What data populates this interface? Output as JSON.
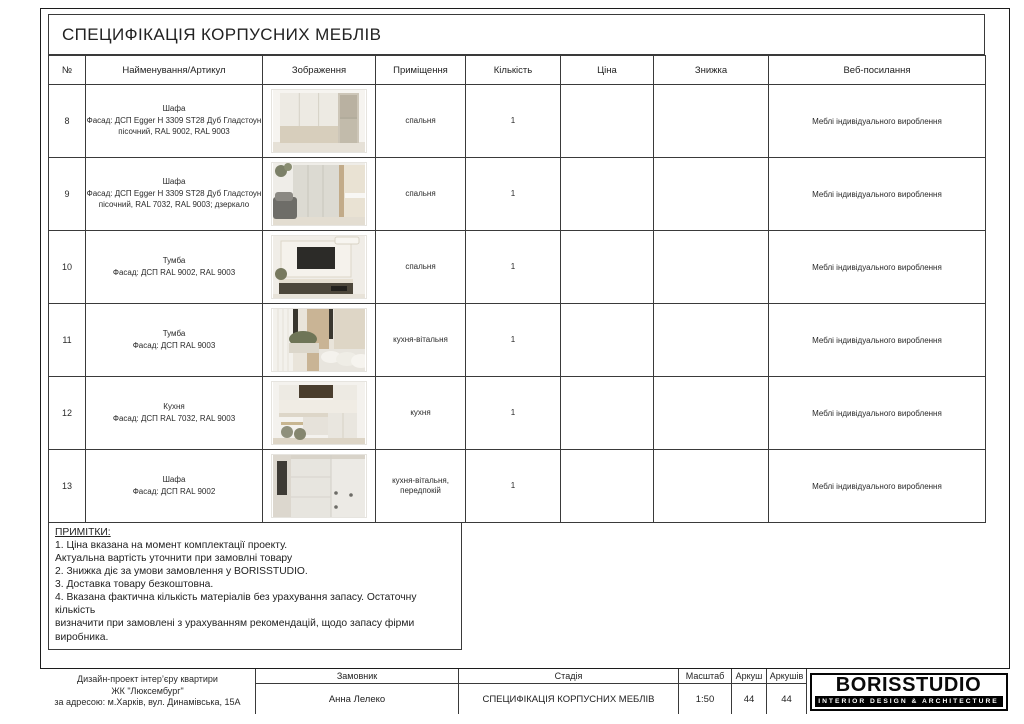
{
  "title": "СПЕЦИФІКАЦІЯ КОРПУСНИХ МЕБЛІВ",
  "colors": {
    "border": "#3a3a3a",
    "outer_border": "#1c1c1c",
    "text": "#222222",
    "logo_bg": "#000000",
    "logo_text": "#ffffff",
    "photo_beige": "#d7cebc",
    "photo_cream": "#edeae3"
  },
  "table": {
    "headers": [
      "№",
      "Найменування/Артикул",
      "Зображення",
      "Приміщення",
      "Кількість",
      "Ціна",
      "Знижка",
      "Веб-посилання"
    ],
    "rows": [
      {
        "num": "8",
        "name": "Шафа",
        "desc": "Фасад: ДСП Egger H 3309 ST28 Дуб Гладстоун пісочний, RAL 9002, RAL 9003",
        "image": "wardrobe-bedroom-photo",
        "room": "спальня",
        "qty": "1",
        "price": "",
        "discount": "",
        "link": "Меблі індивідуального вироблення"
      },
      {
        "num": "9",
        "name": "Шафа",
        "desc": "Фасад: ДСП Egger H 3309 ST28 Дуб Гладстоун пісочний, RAL 7032, RAL 9003; дзеркало",
        "image": "wardrobe-mirror-photo",
        "room": "спальня",
        "qty": "1",
        "price": "",
        "discount": "",
        "link": "Меблі індивідуального вироблення"
      },
      {
        "num": "10",
        "name": "Тумба",
        "desc": "Фасад: ДСП RAL 9002, RAL 9003",
        "image": "tv-stand-photo",
        "room": "спальня",
        "qty": "1",
        "price": "",
        "discount": "",
        "link": "Меблі індивідуального вироблення"
      },
      {
        "num": "11",
        "name": "Тумба",
        "desc": "Фасад: ДСП RAL 9003",
        "image": "cabinet-living-photo",
        "room": "кухня-вітальня",
        "qty": "1",
        "price": "",
        "discount": "",
        "link": "Меблі індивідуального вироблення"
      },
      {
        "num": "12",
        "name": "Кухня",
        "desc": "Фасад: ДСП RAL 7032, RAL 9003",
        "image": "kitchen-photo",
        "room": "кухня",
        "qty": "1",
        "price": "",
        "discount": "",
        "link": "Меблі індивідуального вироблення"
      },
      {
        "num": "13",
        "name": "Шафа",
        "desc": "Фасад: ДСП RAL 9002",
        "image": "hallway-wardrobe-photo",
        "room": "кухня-вітальня, передпокій",
        "qty": "1",
        "price": "",
        "discount": "",
        "link": "Меблі індивідуального вироблення"
      }
    ]
  },
  "notes": {
    "heading": "ПРИМІТКИ:",
    "lines": [
      "1. Ціна вказана на момент комплектації проекту.",
      "Актуальна вартість уточнити при замовлні товару",
      "2. Знижка діє за умови замовлення у BORISSTUDIO.",
      "3. Доставка товару безкоштовна.",
      "4. Вказана фактична кількість матеріалів без урахування запасу. Остаточну кількість",
      "визначити при замовлені з урахуванням рекомендацій, щодо запасу фірми виробника."
    ]
  },
  "footer": {
    "project": [
      "Дизайн-проект інтер’єру квартири",
      "ЖК \"Люксембург\"",
      "за адресою: м.Харків, вул. Динамівська, 15А"
    ],
    "customer_label": "Замовник",
    "customer": "Анна Лелеко",
    "stage_label": "Стадія",
    "stage": "СПЕЦИФІКАЦІЯ КОРПУСНИХ МЕБЛІВ",
    "scale_label": "Масштаб",
    "scale": "1:50",
    "sheet_label": "Аркуш",
    "sheet": "44",
    "sheets_label": "Аркушів",
    "sheets": "44",
    "logo": {
      "name": "BORISSTUDIO",
      "tagline": "INTERIOR DESIGN & ARCHITECTURE"
    }
  }
}
